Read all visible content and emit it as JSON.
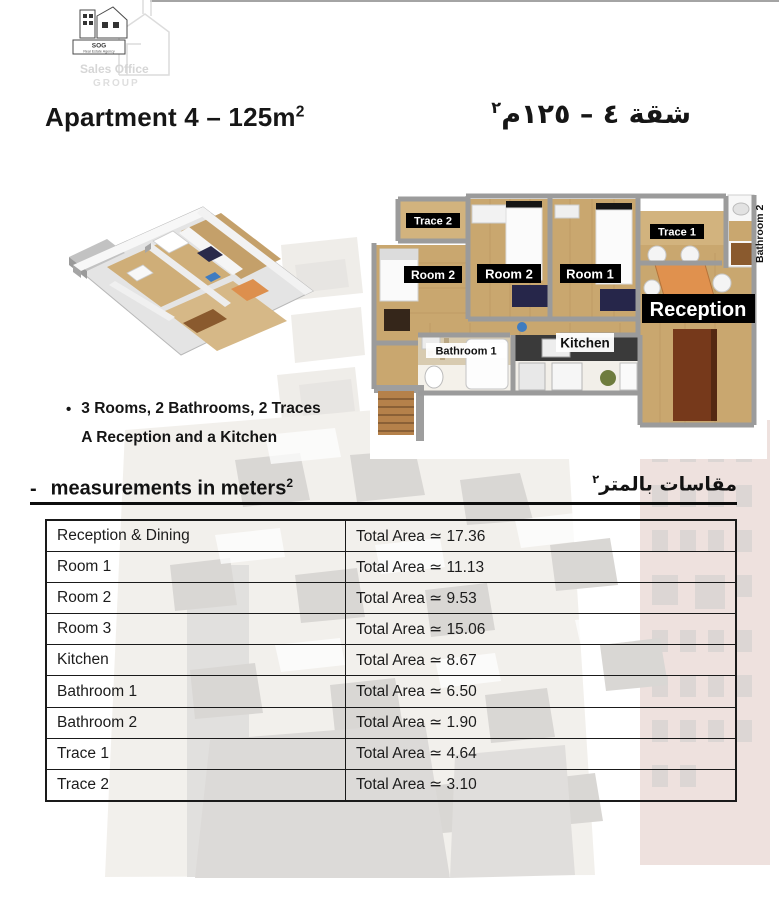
{
  "logo": {
    "acronym": "SOG",
    "tagline": "Real Estate Agency",
    "watermark_top": "Sales Office",
    "watermark_bottom": "GROUP"
  },
  "header": {
    "title_en_main": "Apartment 4 – 125m",
    "title_en_sup": "2",
    "title_ar_main": "شقة ٤ – ١٢٥م",
    "title_ar_sup": "٢"
  },
  "floor_plan": {
    "labels": {
      "trace2": "Trace 2",
      "room2_left": "Room 2",
      "room2_mid": "Room 2",
      "room1": "Room 1",
      "trace1": "Trace 1",
      "bathroom2": "Bathroom 2",
      "reception": "Reception",
      "bathroom1": "Bathroom 1",
      "kitchen": "Kitchen"
    },
    "colors": {
      "wood_floor": "#c9a76f",
      "label_bg": "#000000",
      "label_text": "#ffffff",
      "reception_table": "#e0914e",
      "cabinet_brown": "#76391b",
      "rug_navy": "#26264a"
    }
  },
  "features": {
    "bullet": "•",
    "line1": "3 Rooms, 2 Bathrooms, 2 Traces",
    "line2": "A Reception and a Kitchen"
  },
  "measurements": {
    "heading_dash": "-",
    "heading_en_main": "measurements in meters",
    "heading_en_sup": "2",
    "heading_ar_main": "مقاسات بالمتر",
    "heading_ar_sup": "٢"
  },
  "table": {
    "rows": [
      {
        "label": "Reception & Dining",
        "value": "Total Area ≃ 17.36"
      },
      {
        "label": "Room 1",
        "value": "Total Area ≃ 11.13"
      },
      {
        "label": "Room 2",
        "value": "Total Area ≃ 9.53"
      },
      {
        "label": "Room 3",
        "value": "Total Area ≃ 15.06"
      },
      {
        "label": "Kitchen",
        "value": "Total Area ≃ 8.67"
      },
      {
        "label": "Bathroom 1",
        "value": "Total Area ≃ 6.50"
      },
      {
        "label": "Bathroom 2",
        "value": "Total Area ≃ 1.90"
      },
      {
        "label": "Trace 1",
        "value": "Total Area ≃ 4.64"
      },
      {
        "label": "Trace 2",
        "value": "Total Area ≃ 3.10"
      }
    ]
  }
}
